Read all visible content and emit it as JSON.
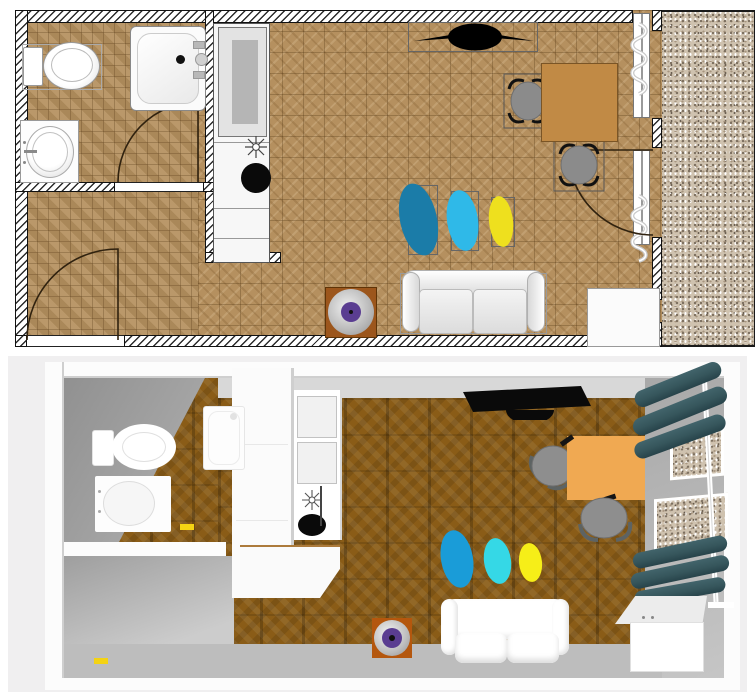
{
  "scene": {
    "views": [
      {
        "name": "plan-2d",
        "type": "top-down floor plan"
      },
      {
        "name": "view-3d",
        "type": "3d aerial rendering"
      }
    ]
  },
  "plan2d": {
    "rooms": [
      "bathroom",
      "hallway",
      "kitchen",
      "living-room",
      "balcony"
    ],
    "bathroom_items": [
      "toilet",
      "shower-tray",
      "washbasin",
      "bathroom-door"
    ],
    "hallway_items": [
      "entry-door"
    ],
    "kitchen_items": [
      "refrigerator",
      "kitchen-counter",
      "cooktop-burner",
      "kitchen-sink"
    ],
    "living_items": [
      "tv",
      "dining-table",
      "dining-chair",
      "dining-chair",
      "window-with-curtain",
      "balcony-door-with-curtain",
      "pouf-teal",
      "pouf-cyan",
      "pouf-yellow",
      "sofa",
      "record-player",
      "low-cabinet"
    ]
  },
  "view3d": {
    "items": [
      "toilet",
      "washbasin",
      "shower-tray",
      "tall-cabinet",
      "kitchen-counter",
      "kitchen-sink",
      "tv",
      "dining-table",
      "dining-chair",
      "dining-chair",
      "curtains-upper",
      "curtains-lower",
      "balcony-windows",
      "pouf-blue",
      "pouf-cyan",
      "pouf-yellow",
      "sofa",
      "record-player",
      "low-cabinet",
      "door-handle-yellow",
      "door-handle-yellow"
    ]
  },
  "colors": {
    "plan_floor_tile": "#b5905f",
    "balcony_gravel": "#cfc2af",
    "table_2d": "#c18a45",
    "table_3d": "#f0a952",
    "chair_seat": "#8b8b8b",
    "pouf_teal_2d": "#1b7ca8",
    "pouf_cyan_2d": "#2fb9e8",
    "pouf_yellow_2d": "#eee01e",
    "pouf_blue_3d": "#1a9cd8",
    "pouf_cyan_3d": "#35d8e6",
    "pouf_yellow_3d": "#f6ee18",
    "vinyl_label": "#5a3d91",
    "record_stand_2d": "#9c561c",
    "record_stand_3d": "#b4570e",
    "curtain_teal": "#36565c",
    "floor_3d": "#8a5c17",
    "hall_floor_3d": "#c6c6c6",
    "bg_3d": "#f0eff0",
    "yellow_handle": "#f4d313",
    "wall_white": "#fcfcfc",
    "tv_black": "#0a0a0a"
  }
}
